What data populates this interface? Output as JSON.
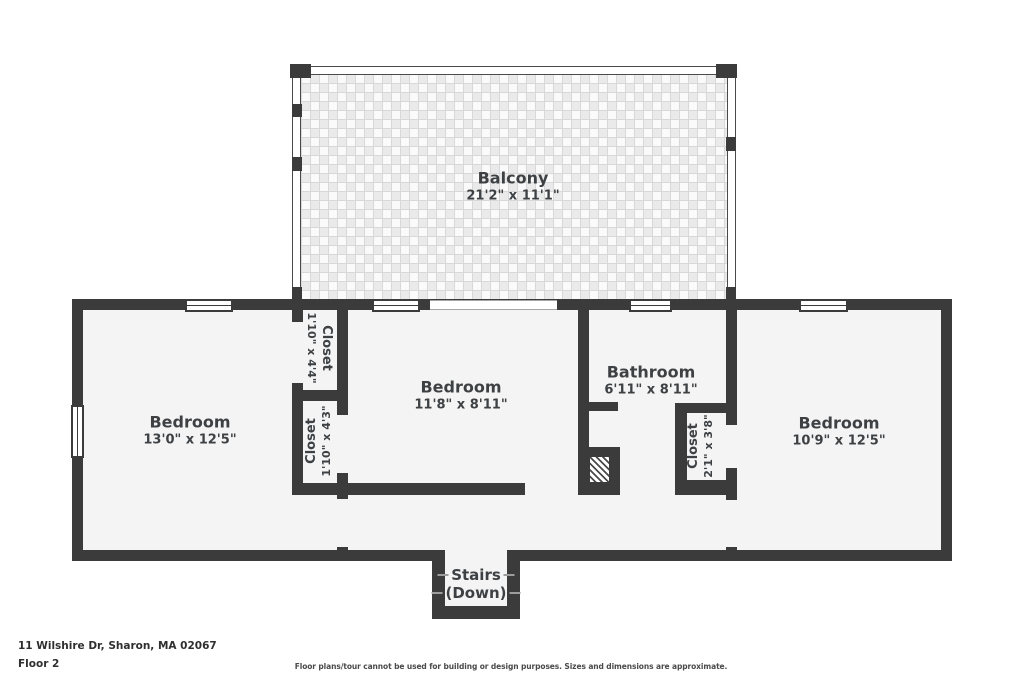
{
  "labels": {
    "balcony": {
      "name": "Balcony",
      "dims": "21'2\" x 11'1\""
    },
    "bedroom_left": {
      "name": "Bedroom",
      "dims": "13'0\" x 12'5\""
    },
    "bedroom_middle": {
      "name": "Bedroom",
      "dims": "11'8\" x 8'11\""
    },
    "bathroom": {
      "name": "Bathroom",
      "dims": "6'11\" x 8'11\""
    },
    "bedroom_right": {
      "name": "Bedroom",
      "dims": "10'9\" x 12'5\""
    },
    "closet_top": {
      "name": "Closet",
      "dims": "1'10\" x 4'4\""
    },
    "closet_bottom": {
      "name": "Closet",
      "dims": "1'10\" x 4'3\""
    },
    "closet_bath": {
      "name": "Closet",
      "dims": "2'1\" x 3'8\""
    },
    "stairs": {
      "line1": "Stairs",
      "line2": "(Down)"
    }
  },
  "footer": {
    "address": "11 Wilshire Dr, Sharon, MA 02067",
    "floor": "Floor 2",
    "disclaimer": "Floor plans/tour cannot be used for building or design purposes. Sizes and dimensions are approximate."
  },
  "colors": {
    "wall": "#3b3b3b",
    "floor": "#f4f4f4",
    "text": "#3e4144"
  }
}
